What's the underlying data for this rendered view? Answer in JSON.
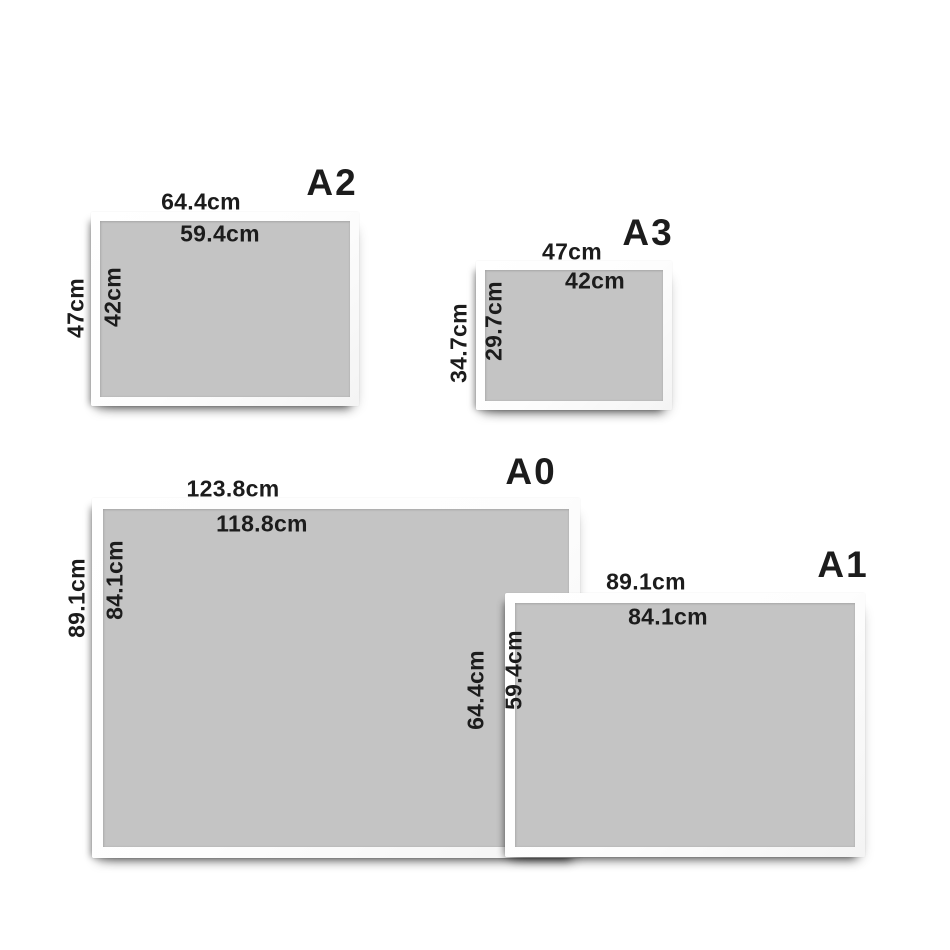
{
  "colors": {
    "background": "#ffffff",
    "sheet": "#ffffff",
    "mat": "#c4c4c4",
    "text": "#1c1c1c"
  },
  "panels": [
    {
      "name": "A2",
      "outer_width": "64.4cm",
      "inner_width": "59.4cm",
      "outer_height": "47cm",
      "inner_height": "42cm"
    },
    {
      "name": "A3",
      "outer_width": "47cm",
      "inner_width": "42cm",
      "outer_height": "34.7cm",
      "inner_height": "29.7cm"
    },
    {
      "name": "A0",
      "outer_width": "123.8cm",
      "inner_width": "118.8cm",
      "outer_height": "89.1cm",
      "inner_height": "84.1cm"
    },
    {
      "name": "A1",
      "outer_width": "89.1cm",
      "inner_width": "84.1cm",
      "outer_height": "64.4cm",
      "inner_height": "59.4cm"
    }
  ]
}
